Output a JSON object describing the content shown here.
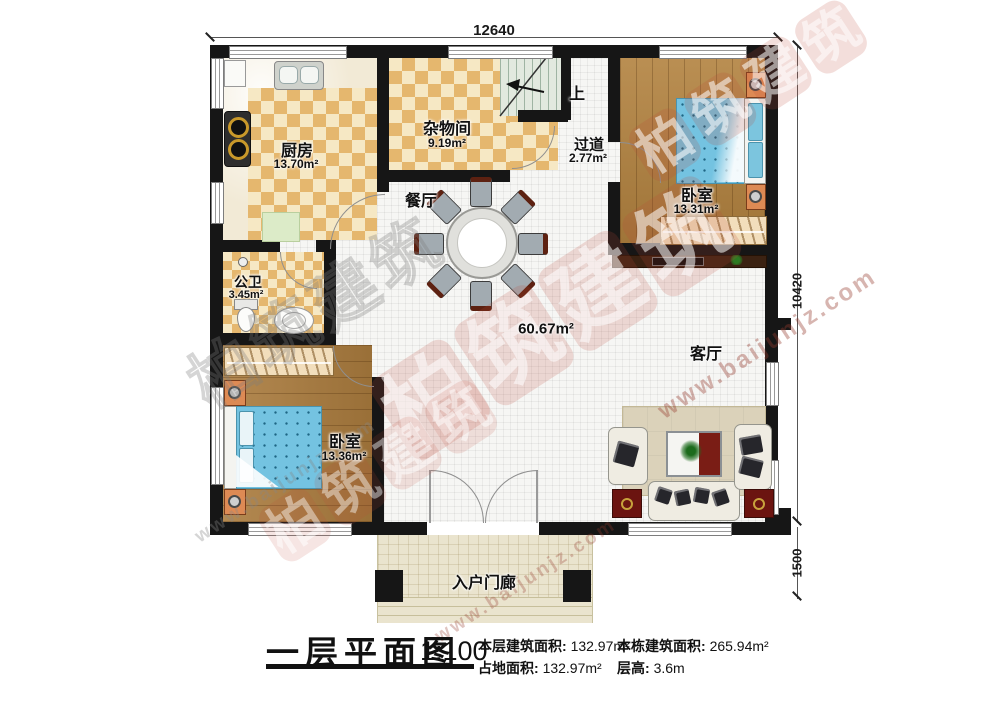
{
  "dimensions": {
    "top": "12640",
    "right": "10420",
    "porch": "1500"
  },
  "rooms": {
    "kitchen": {
      "name": "厨房",
      "area": "13.70m²"
    },
    "storage": {
      "name": "杂物间",
      "area": "9.19m²"
    },
    "corridor": {
      "name": "过道",
      "area": "2.77m²"
    },
    "bedroom_right": {
      "name": "卧室",
      "area": "13.31m²"
    },
    "bedroom_left": {
      "name": "卧室",
      "area": "13.36m²"
    },
    "bathroom": {
      "name": "公卫",
      "area": "3.45m²"
    },
    "dining": {
      "name": "餐厅"
    },
    "living": {
      "name": "客厅"
    },
    "hall": {
      "area": "60.67m²"
    },
    "porch": {
      "name": "入户门廊"
    },
    "stairs": {
      "up_label": "上"
    }
  },
  "legend": {
    "title": "一层平面图",
    "scale": "1:100",
    "items": [
      {
        "label": "本层建筑面积:",
        "value": "132.97m²"
      },
      {
        "label": "本栋建筑面积:",
        "value": "265.94m²"
      },
      {
        "label": "占地面积:",
        "value": "132.97m²"
      },
      {
        "label": "层高:",
        "value": "3.6m"
      }
    ]
  },
  "watermark": {
    "brand": "柏筑建筑",
    "chars": [
      "柏",
      "筑",
      "建",
      "筑"
    ],
    "url": "www.baijunjz.com"
  },
  "colors": {
    "wall": "#161616",
    "checker_dark": "#e5b76e",
    "checker_light": "#f6e8c4",
    "wood": "#b2823f",
    "bed_blue": "#74c3e1",
    "nightstand_orange": "#dd8a54",
    "stair_green": "#e2e9df",
    "porch_beige": "#eae4ce",
    "rug_beige": "#dbd2ba",
    "table_red": "#6b1410",
    "stamp_red": "#ba4838"
  }
}
